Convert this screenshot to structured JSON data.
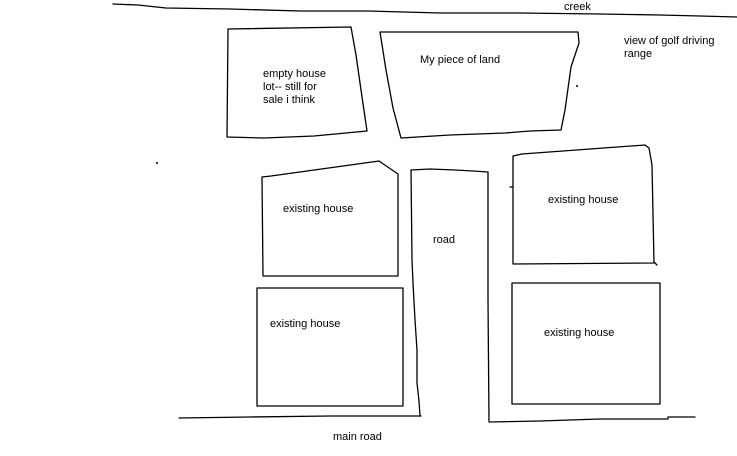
{
  "canvas": {
    "background": "#ffffff",
    "ink": "#000000"
  },
  "labels": {
    "creek": "creek",
    "golf_view": "view of golf driving\nrange",
    "empty_lot": "empty house\nlot-- still for\nsale i think",
    "my_land": "My piece of land",
    "house_top_left": "existing house",
    "house_bottom_left": "existing house",
    "house_top_right": "existing house",
    "house_bottom_right": "existing house",
    "road": "road",
    "main_road": "main road"
  }
}
